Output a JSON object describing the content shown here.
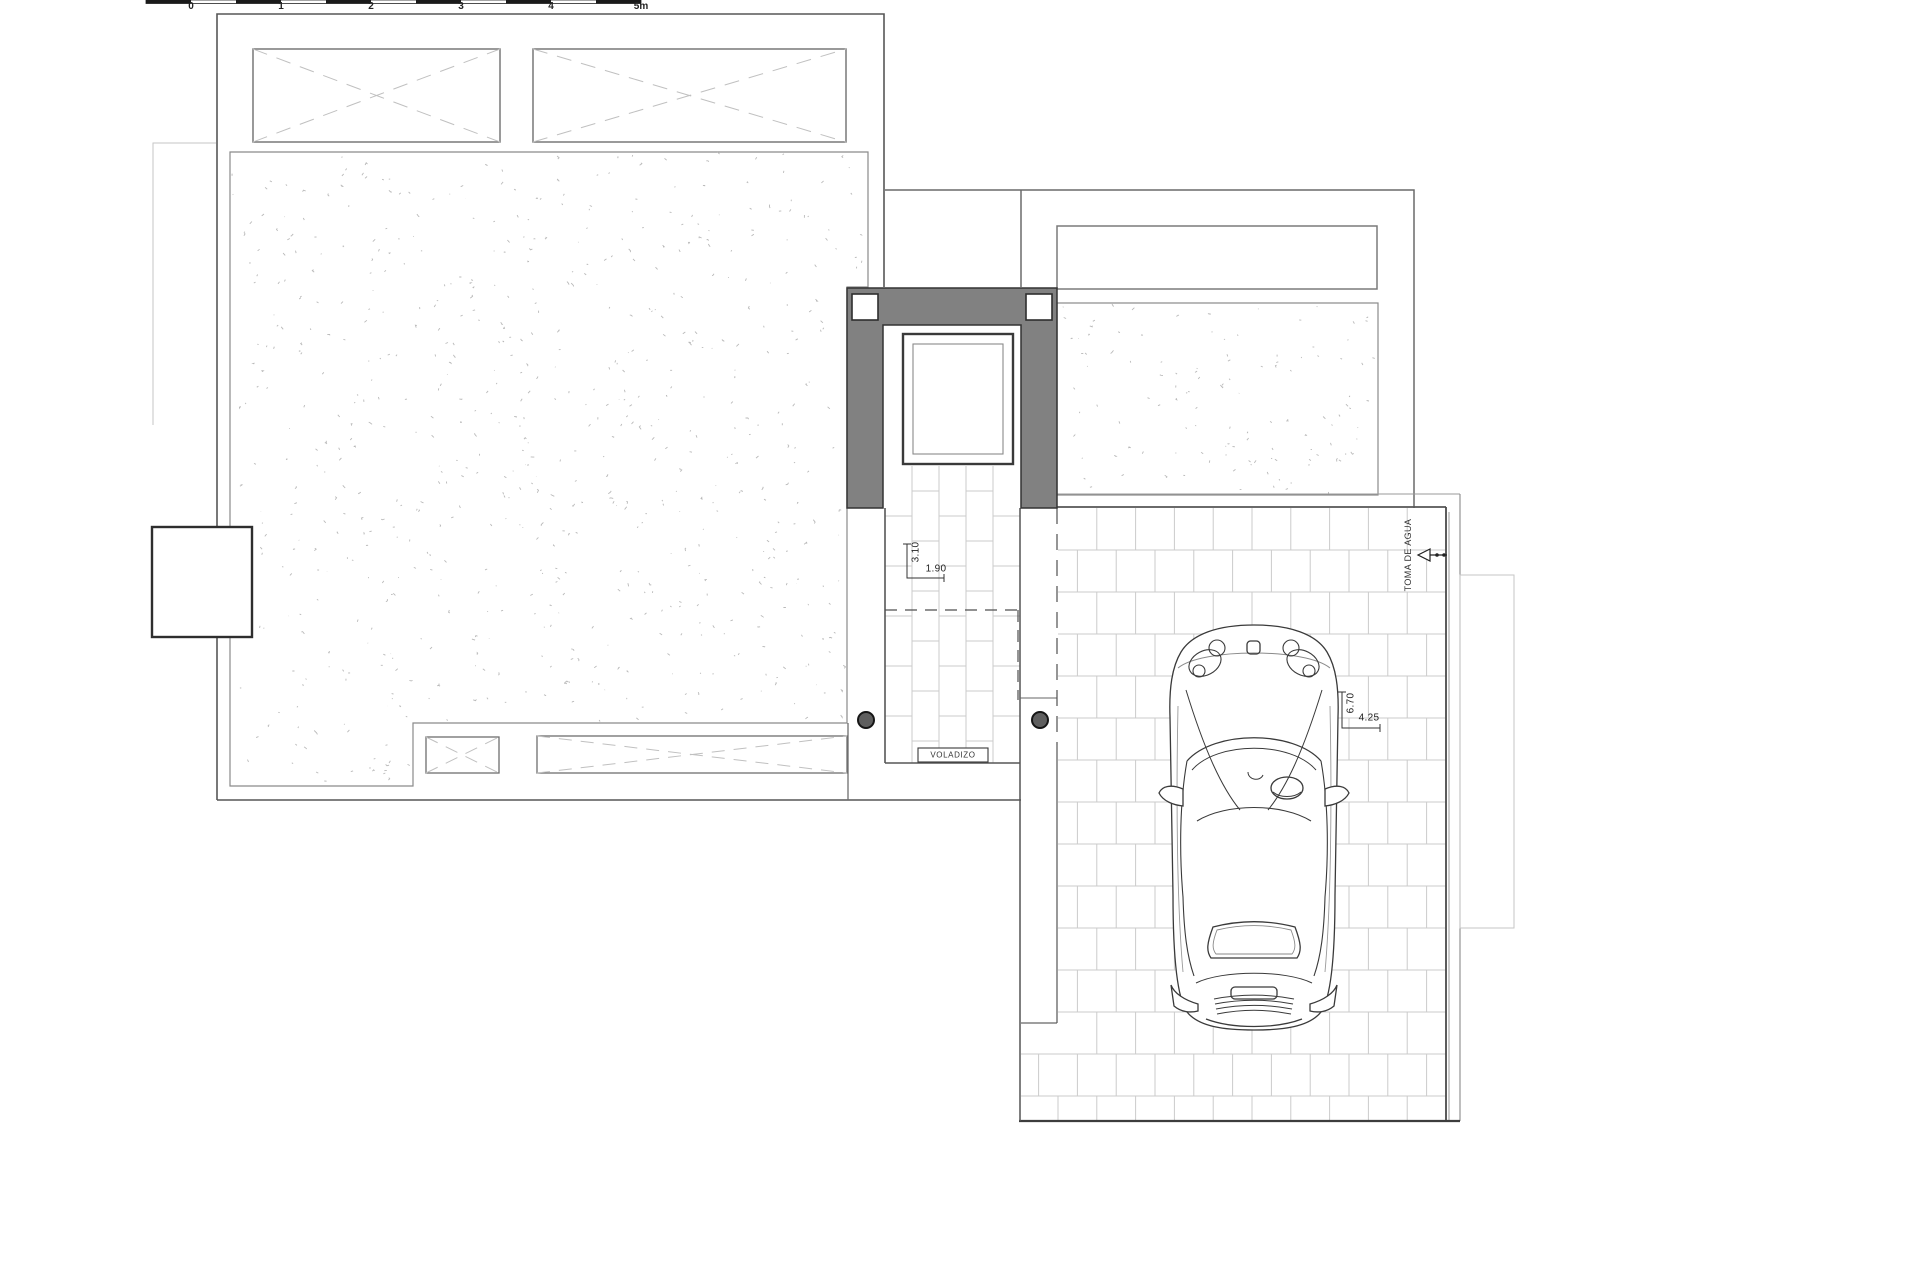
{
  "plan": {
    "scale_bar": {
      "labels": [
        "0",
        "1",
        "2",
        "3",
        "4",
        "5m"
      ]
    },
    "annotations": {
      "voladizo": "VOLADIZO",
      "toma_de_agua": "TOMA DE AGUA",
      "dim_stair_depth": "3.10",
      "dim_stair_width": "1.90",
      "dim_parking_length": "6.70",
      "dim_car_length": "4.25"
    },
    "pillar_count": 2,
    "colors": {
      "background": "#ffffff",
      "wall_fill": "#818181",
      "outline": "#565656",
      "thin_line": "#8a8a8a",
      "faint_line": "#c6c6c6",
      "tile_line": "#cbcbcb",
      "stipple": "#b9b9b9",
      "text": "#222222"
    }
  }
}
